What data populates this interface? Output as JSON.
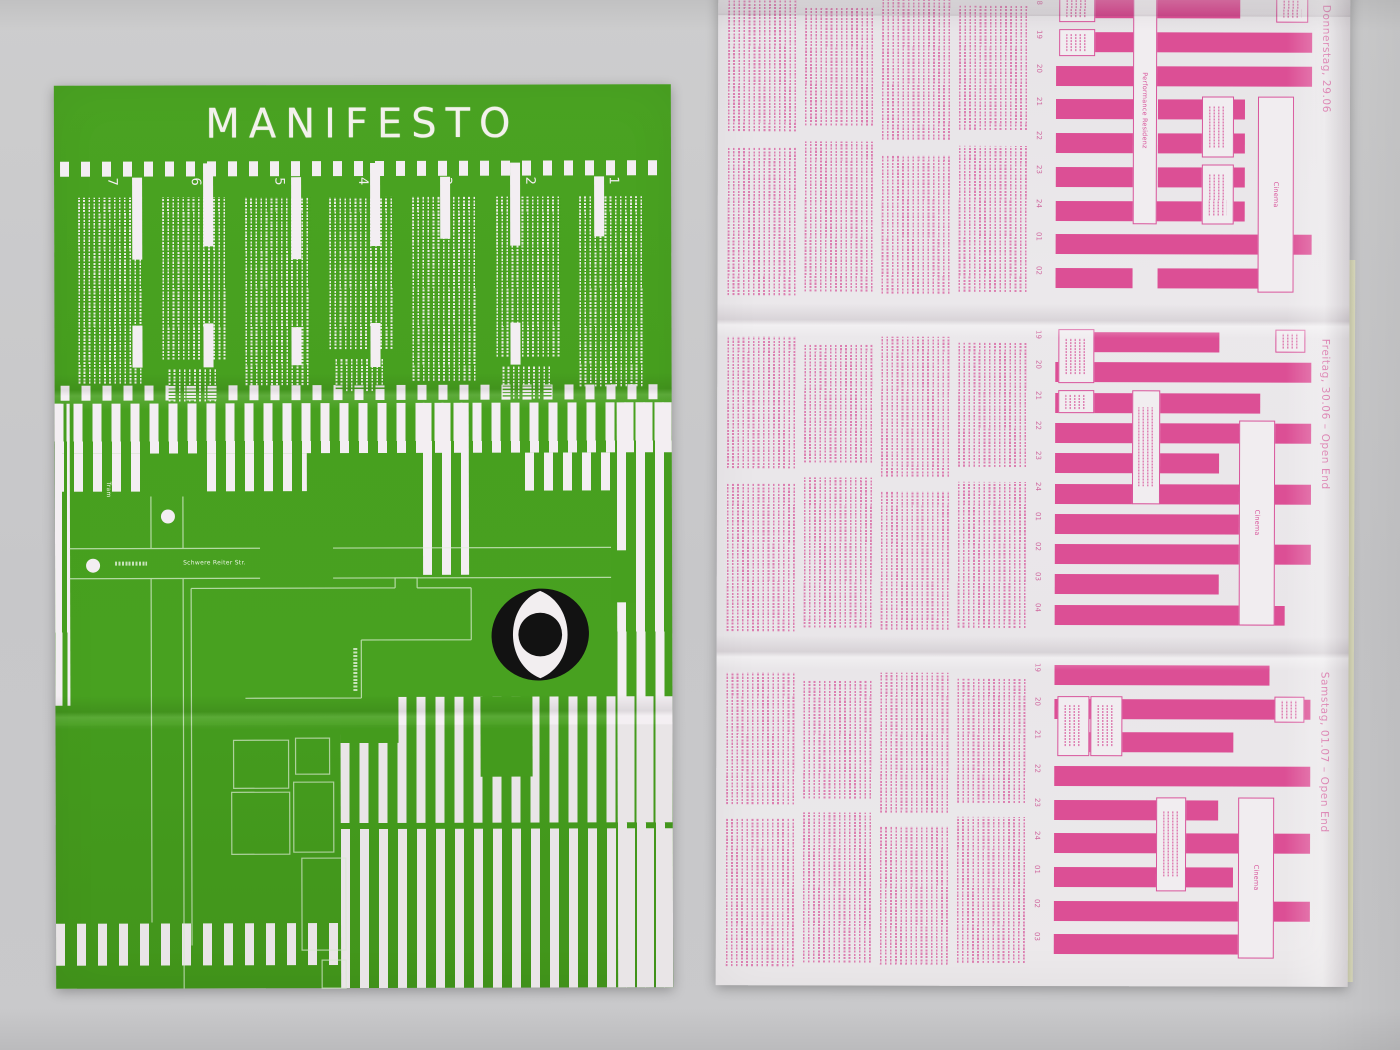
{
  "left_poster": {
    "title": "MANIFESTO",
    "section_numbers": [
      "7",
      "6",
      "5",
      "4",
      "3",
      "2",
      "1"
    ],
    "map": {
      "tram_label": "Tram",
      "street_label": "Schwere Reiter Str."
    },
    "logo": "eye-logo",
    "colors": {
      "green": "#47a01f",
      "stripe_white": "#f3eef2"
    }
  },
  "right_poster": {
    "colors": {
      "pink": "#d8549b",
      "paper": "#eae7ea"
    },
    "bands": [
      {
        "date": "Donnerstag, 29.06",
        "hours": [
          "18",
          "19",
          "20",
          "21",
          "22",
          "23",
          "24",
          "01",
          "02"
        ],
        "event_labels": [
          "Performance Residenz",
          "Cinema"
        ]
      },
      {
        "date": "Freitag, 30.06 – Open End",
        "hours": [
          "19",
          "20",
          "21",
          "22",
          "23",
          "24",
          "01",
          "02",
          "03",
          "04"
        ],
        "event_labels": [
          "Cinema"
        ]
      },
      {
        "date": "Samstag, 01.07 – Open End",
        "hours": [
          "19",
          "20",
          "21",
          "22",
          "23",
          "24",
          "01",
          "02",
          "03"
        ],
        "event_labels": [
          "Cinema"
        ]
      }
    ]
  }
}
